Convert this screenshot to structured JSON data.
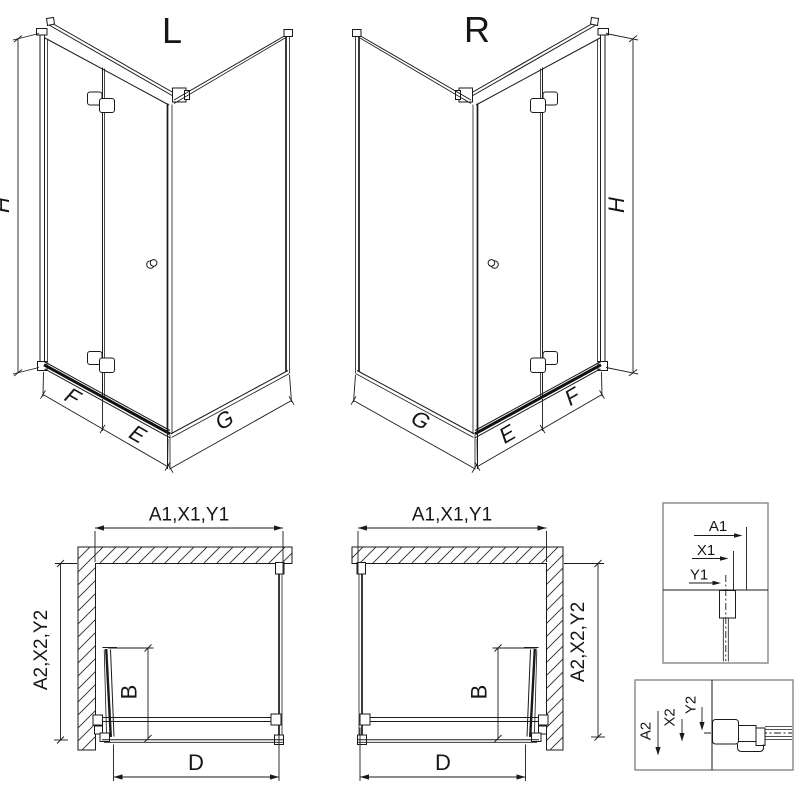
{
  "iso_left": {
    "title": "L",
    "dims": {
      "h": "H",
      "f": "F",
      "e": "E",
      "g": "G"
    }
  },
  "iso_right": {
    "title": "R",
    "dims": {
      "h": "H",
      "f": "F",
      "e": "E",
      "g": "G"
    }
  },
  "plan_left": {
    "dims": {
      "top": "A1,X1,Y1",
      "side": "A2,X2,Y2",
      "door": "B",
      "entry": "D"
    }
  },
  "plan_right": {
    "dims": {
      "top": "A1,X1,Y1",
      "side": "A2,X2,Y2",
      "door": "B",
      "entry": "D"
    }
  },
  "detail_top": {
    "dims": {
      "a": "A1",
      "x": "X1",
      "y": "Y1"
    }
  },
  "detail_bottom": {
    "dims": {
      "a": "A2",
      "x": "X2",
      "y": "Y2"
    }
  },
  "colors": {
    "line": "#1a1a1a",
    "detail_box_border": "#868686",
    "background": "#ffffff"
  }
}
